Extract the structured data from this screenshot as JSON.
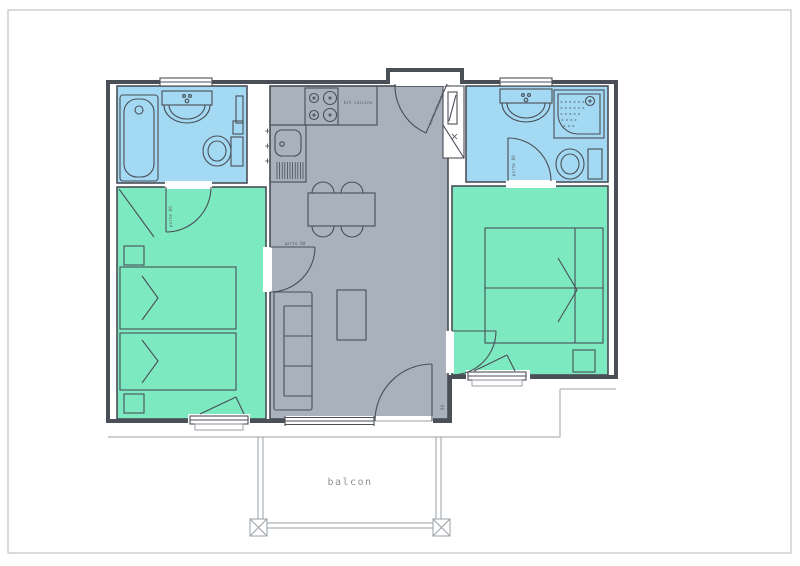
{
  "colors": {
    "bathroom": "#a3d9f2",
    "bedroom": "#7ce9c1",
    "living": "#a9b2bc"
  },
  "labels": {
    "balcony": "balcon",
    "door": "porte 80",
    "entrance_door": "porte 90x2.10",
    "kitchen_unit": "kit cuisine",
    "balcony_door": "90"
  }
}
